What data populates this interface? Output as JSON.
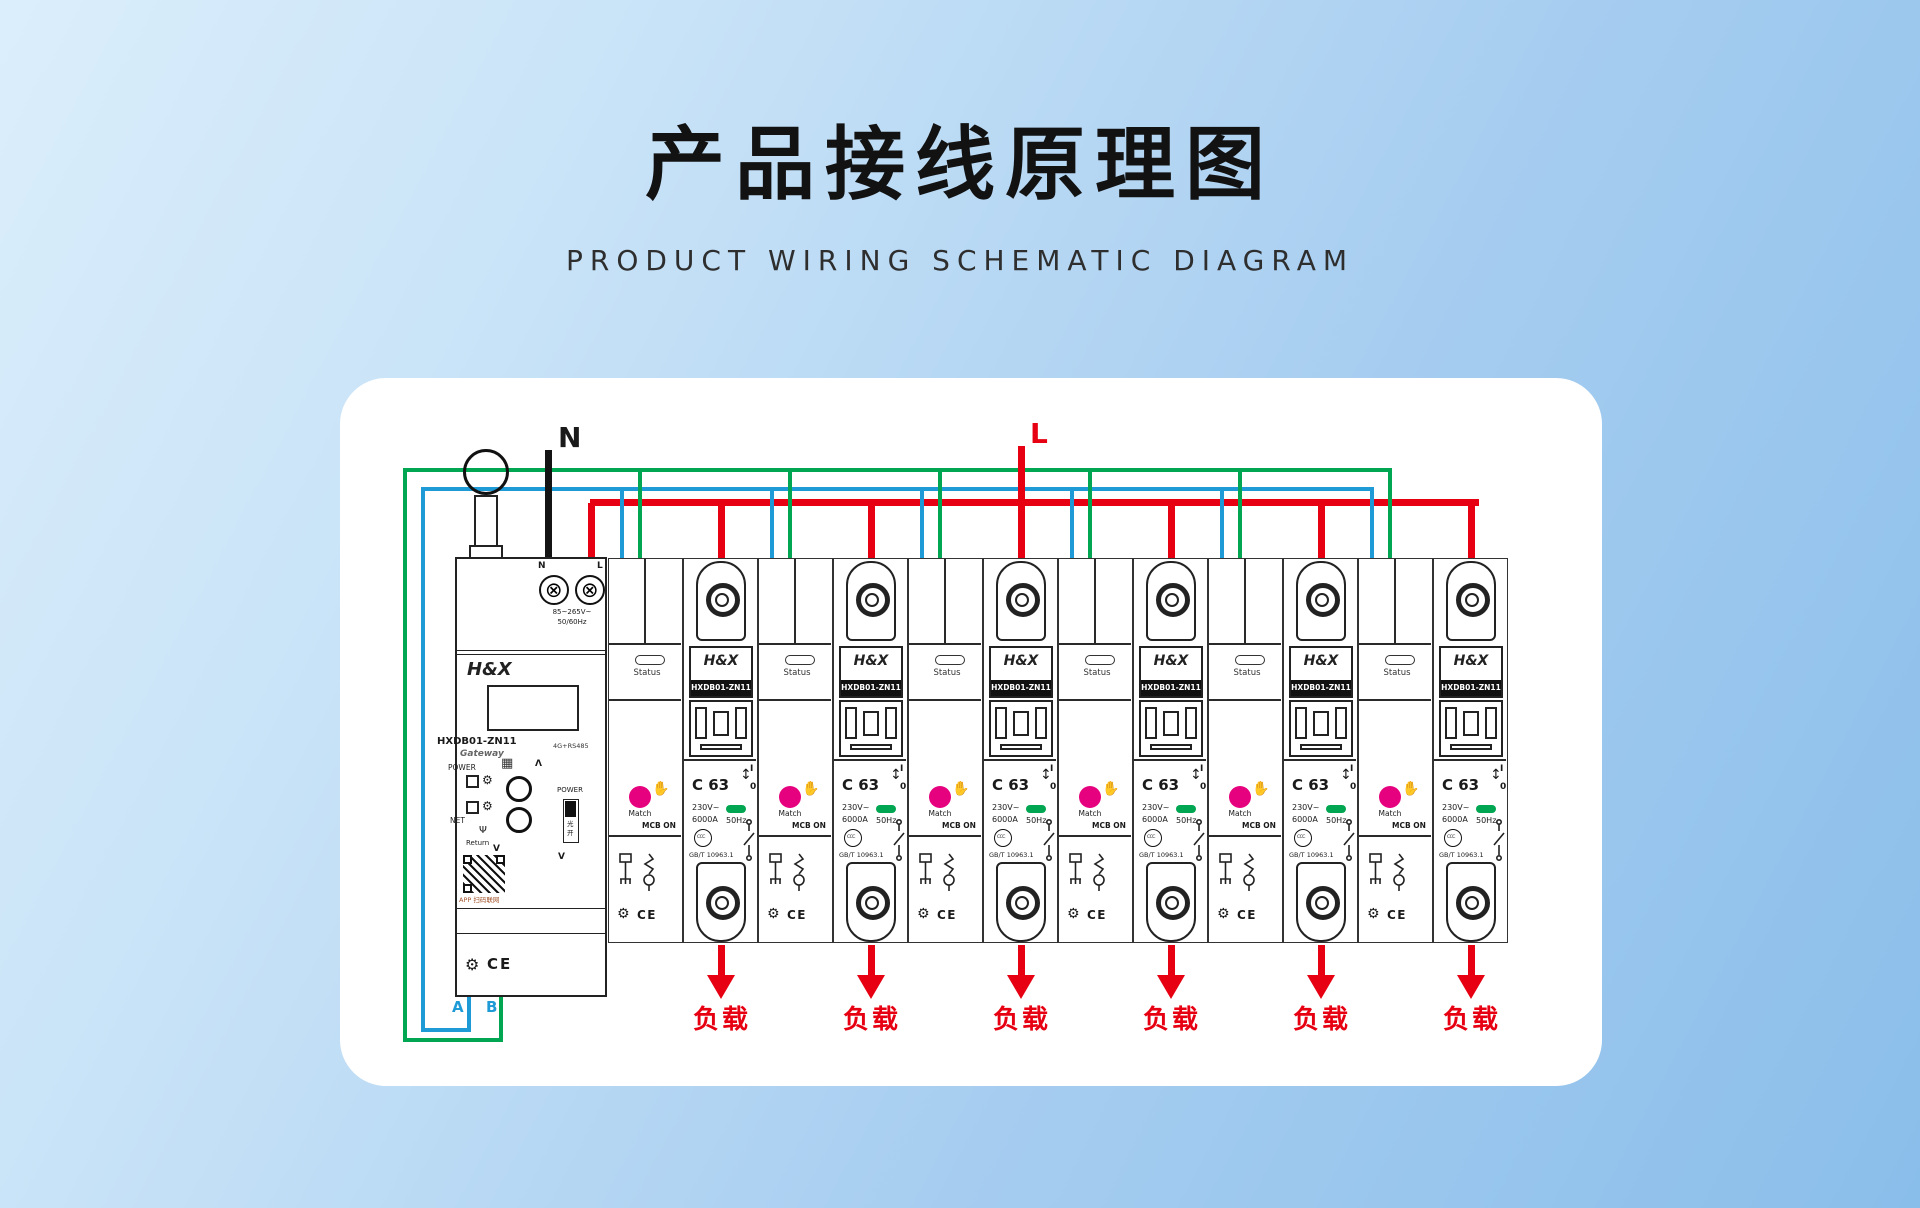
{
  "page": {
    "title": "产品接线原理图",
    "subtitle": "PRODUCT WIRING SCHEMATIC DIAGRAM"
  },
  "colors": {
    "green": "#00a651",
    "blue": "#1e9ad6",
    "red": "#e60012",
    "black": "#141414",
    "pink": "#e6017e",
    "ledgreen": "#00a651",
    "abtext": "#1e9ad6",
    "qrcaption": "#a4542c"
  },
  "wiring": {
    "neutral_label": "N",
    "live_label": "L",
    "a_label": "A",
    "b_label": "B"
  },
  "icons": {
    "gear": "⚙",
    "hand": "✋",
    "grid": "▦",
    "antenna": "Ψ",
    "screw": "⊕",
    "updown": "↕"
  },
  "gateway": {
    "brand": "H&X",
    "model": "HXDB01-ZN11",
    "device_type": "Gateway",
    "terminal_n": "N",
    "terminal_l": "L",
    "voltage": "85~265V~",
    "frequency": "50/60Hz",
    "comm": "4G+RS485",
    "power_label": "POWER",
    "net_label": "NET",
    "return_label": "Return",
    "up_label": "Λ",
    "down_label": "V",
    "side_power_label": "POWER",
    "side_switch_text": "光开",
    "qr_caption": "APP 扫码联网",
    "cert": "CE"
  },
  "breaker": {
    "count": 6,
    "brand": "H&X",
    "model": "HXDB01-ZN11",
    "status_label": "Status",
    "match_label": "Match",
    "mcb_on_label": "MCB ON",
    "rating": "C 63",
    "voltage": "230V~",
    "breaking_capacity": "6000A",
    "frequency": "50Hz",
    "standard": "GB/T 10963.1",
    "on_mark": "I",
    "off_mark": "0",
    "ccc_mark": "CCC",
    "cert": "CE",
    "load_label": "负载"
  }
}
